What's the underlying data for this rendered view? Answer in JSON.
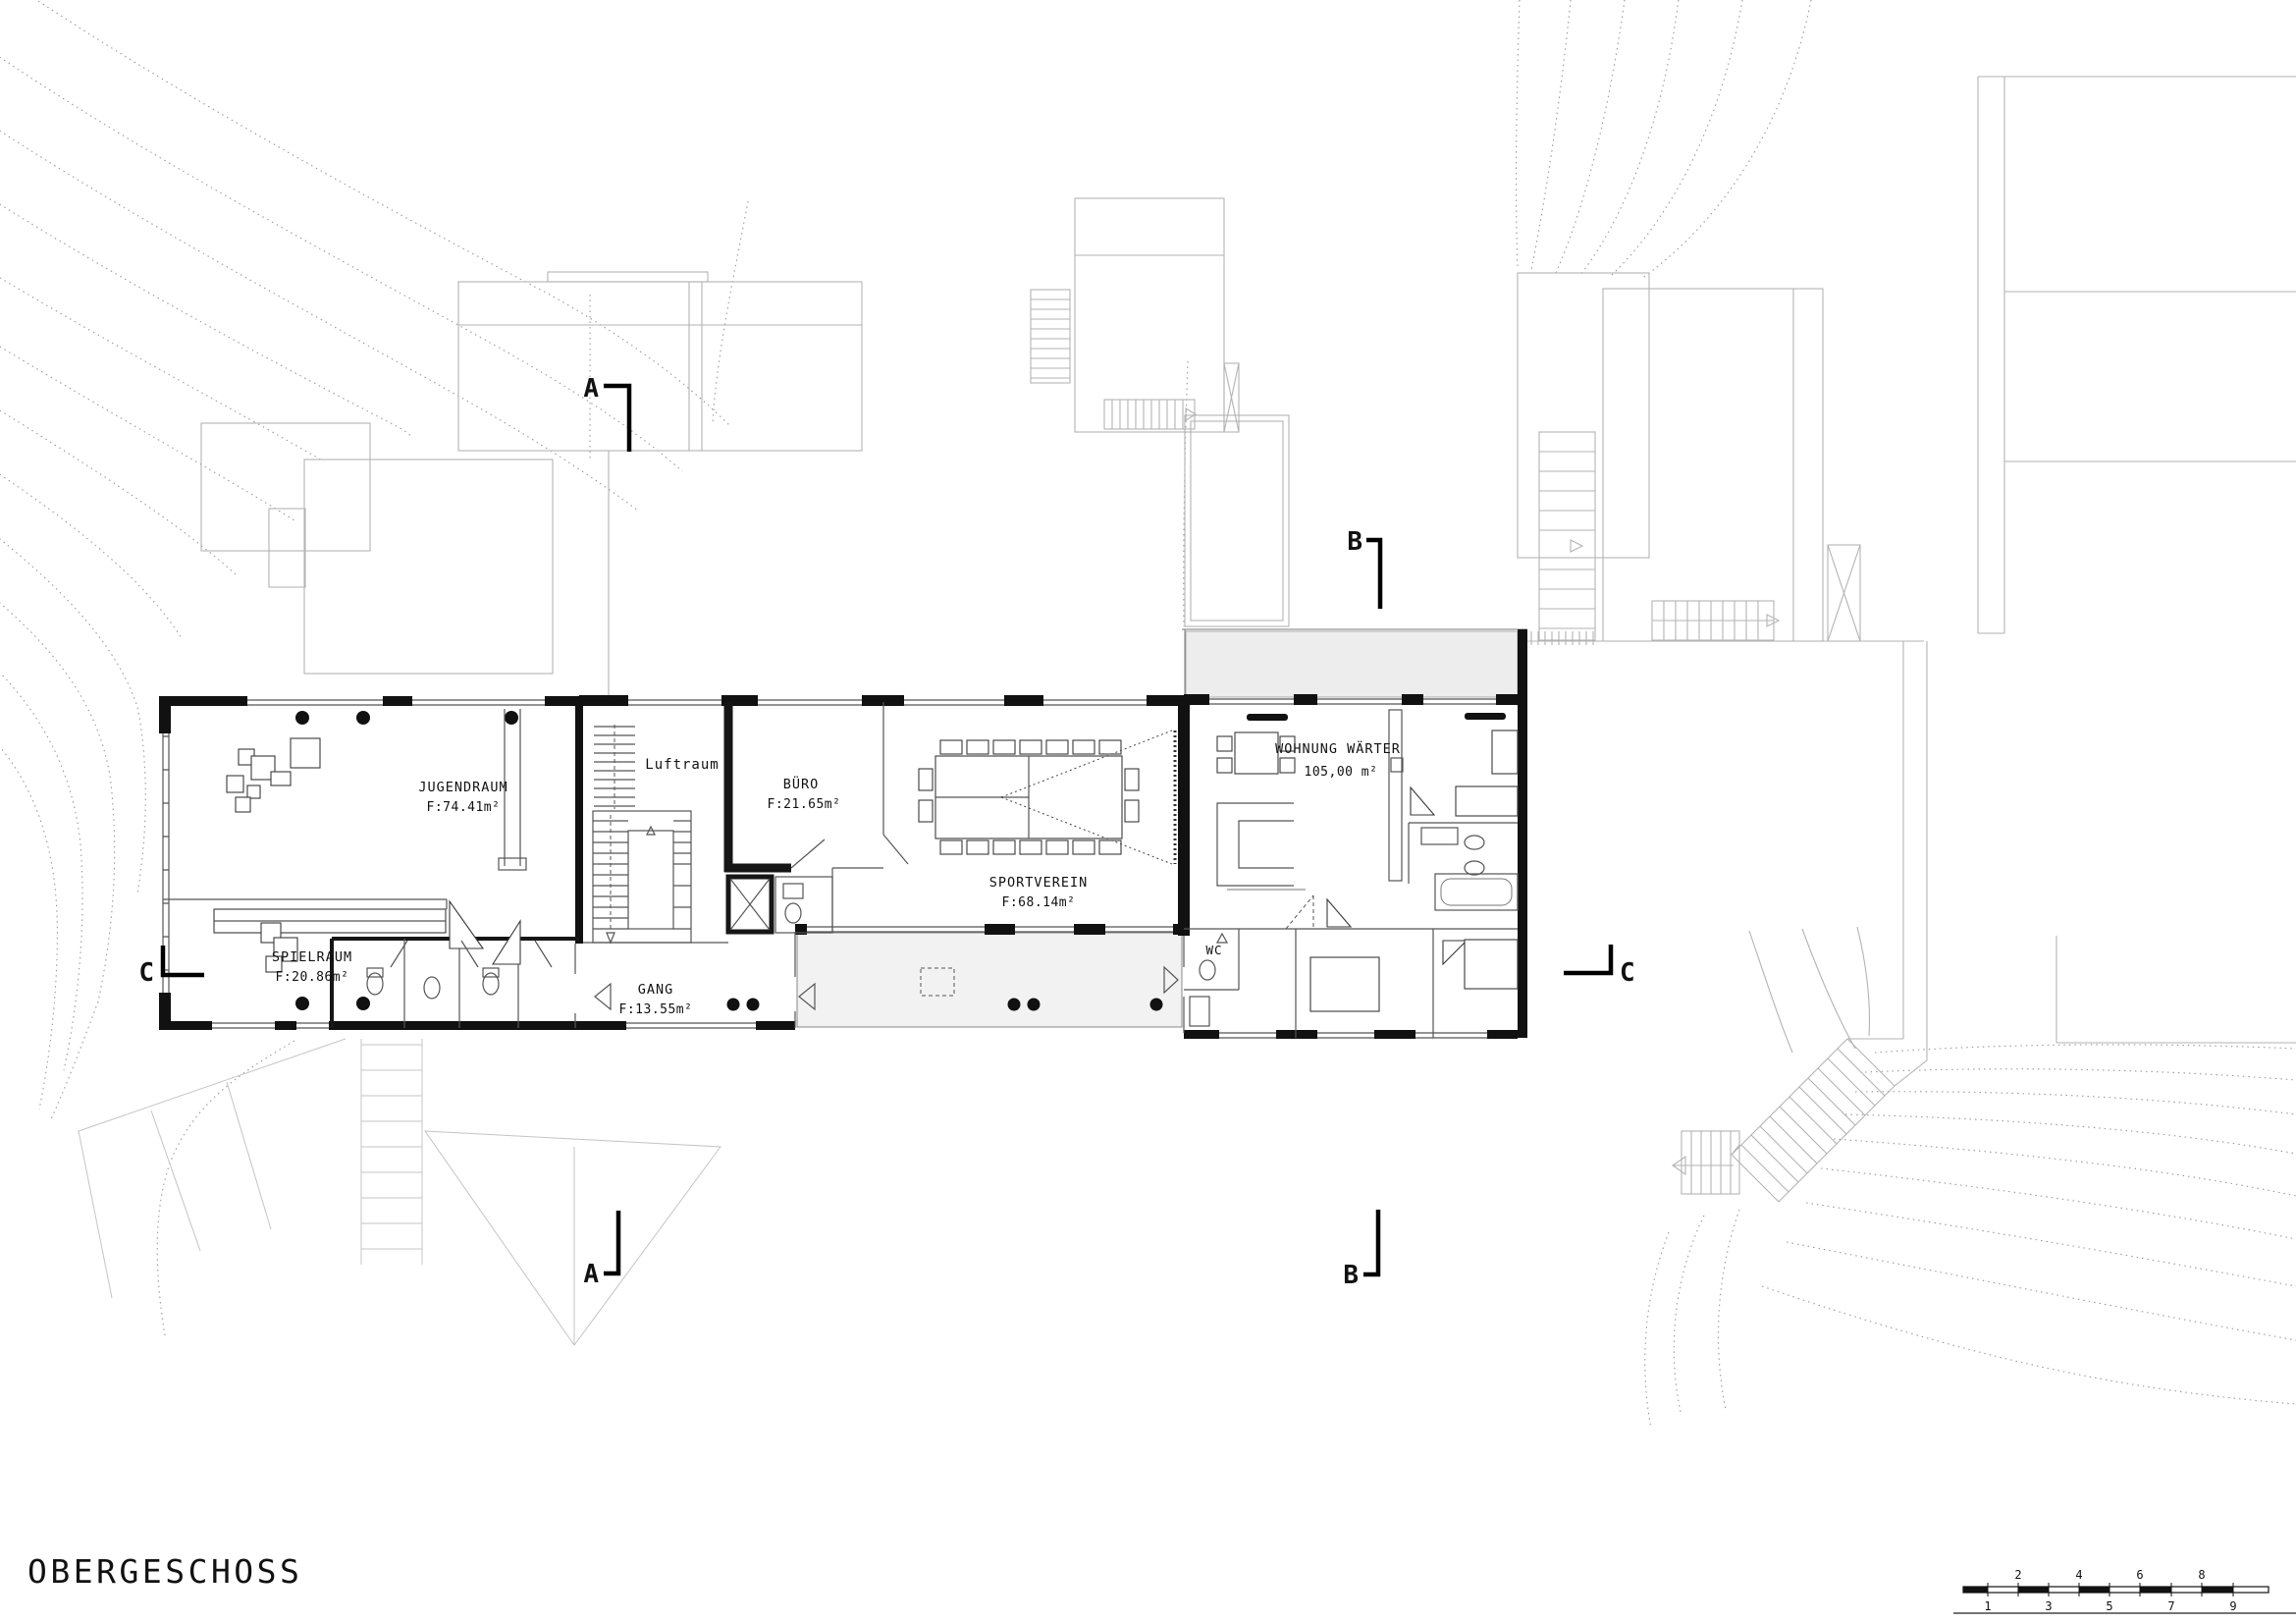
{
  "drawing": {
    "title": "OBERGESCHOSS",
    "rooms": {
      "jugendraum": {
        "name": "JUGENDRAUM",
        "area": "F:74.41m²"
      },
      "spielraum": {
        "name": "SPIELRAUM",
        "area": "F:20.86m²"
      },
      "luftraum": {
        "name": "Luftraum"
      },
      "buero": {
        "name": "BÜRO",
        "area": "F:21.65m²"
      },
      "sportverein": {
        "name": "SPORTVEREIN",
        "area": "F:68.14m²"
      },
      "gang": {
        "name": "GANG",
        "area": "F:13.55m²"
      },
      "wc": {
        "name": "WC"
      },
      "wohnung_waerter": {
        "name": "WOHNUNG WÄRTER",
        "area": "105,00 m²"
      }
    },
    "section_markers": {
      "a": "A",
      "b": "B",
      "c": "C"
    },
    "scale_bar": {
      "labels": [
        "1",
        "2",
        "3",
        "4",
        "5",
        "6",
        "7",
        "8",
        "9"
      ]
    }
  }
}
